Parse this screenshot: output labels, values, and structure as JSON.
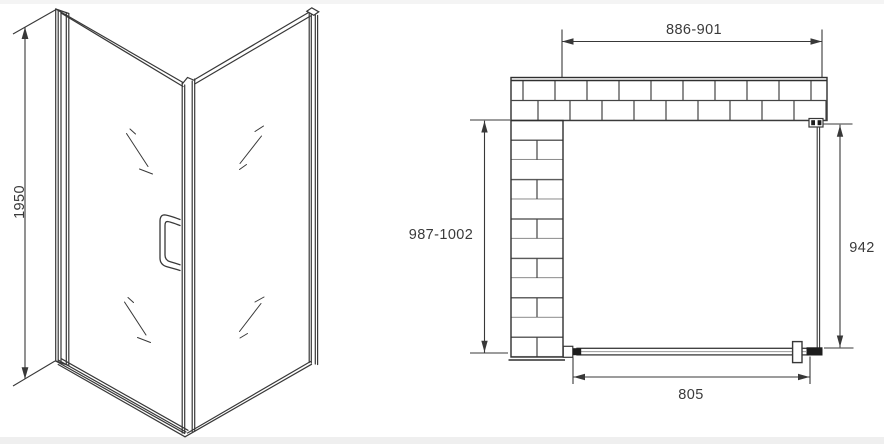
{
  "colors": {
    "line": "#383838",
    "text": "#3a3a3a",
    "background": "#ffffff",
    "hardware_fill": "#1d1d1d"
  },
  "front_view": {
    "height_dimension": "1950"
  },
  "plan_view": {
    "top_opening_dimension": "886-901",
    "left_depth_dimension": "987-1002",
    "fixed_panel_dimension": "942",
    "door_width_dimension": "805"
  }
}
